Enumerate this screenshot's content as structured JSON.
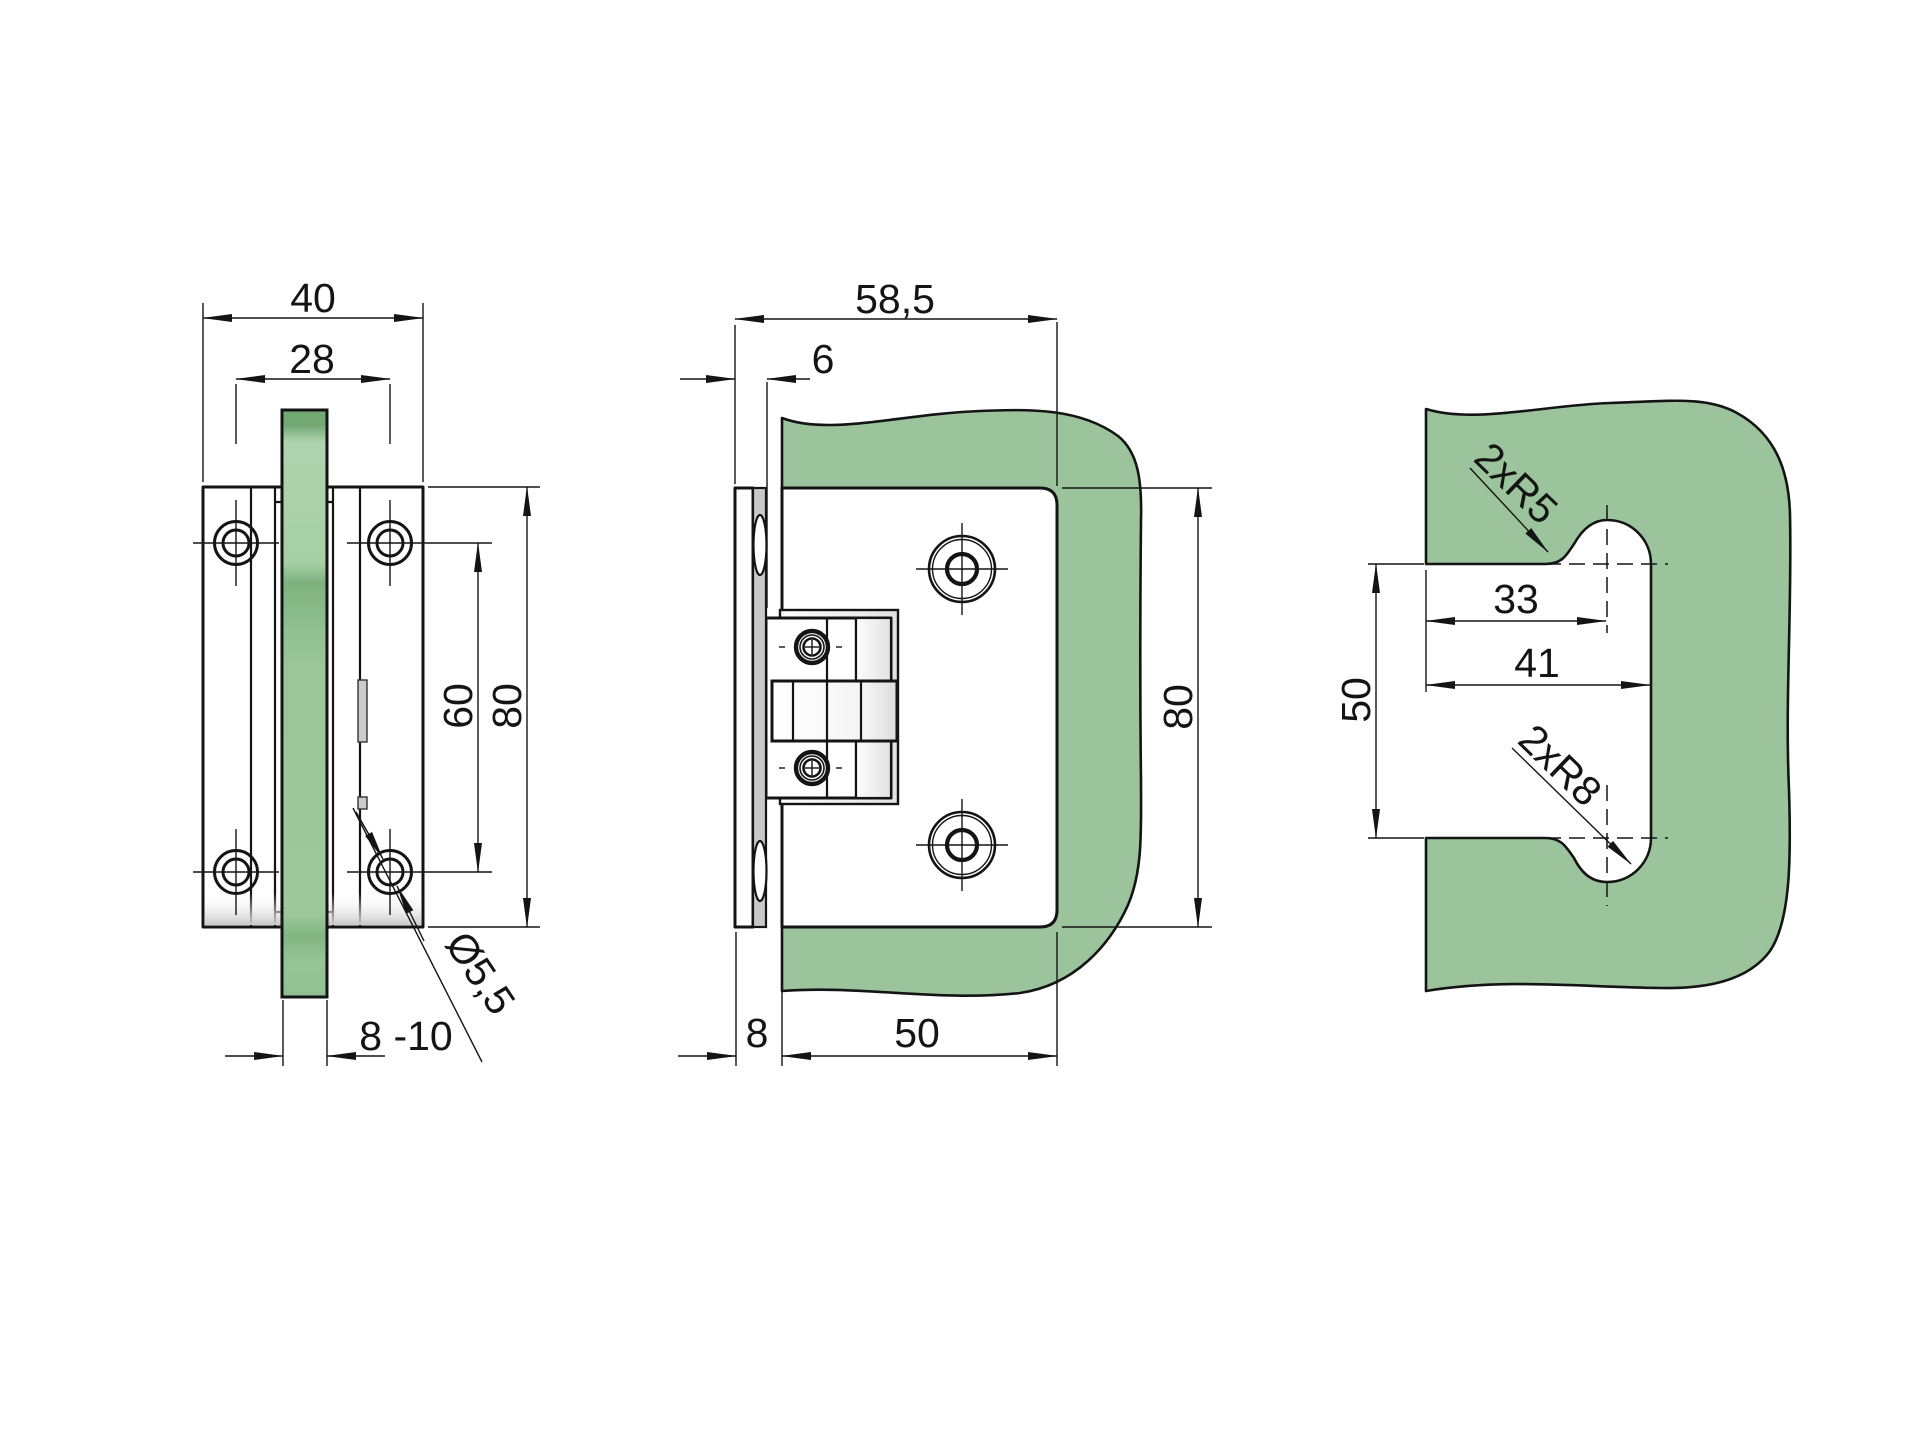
{
  "page": {
    "background": "#ffffff"
  },
  "colors": {
    "glass_green": "#9cc49c",
    "glass_light": "#b0d4b0",
    "glass_dark": "#74a974",
    "gasket_gray": "#c8c8c8",
    "pin_gray": "#cccccc",
    "line": "#141414"
  },
  "views": {
    "front": {
      "label": "hinge-front-view",
      "dims": {
        "width": "40",
        "hole_spacing": "28",
        "hole_pitch": "60",
        "height": "80",
        "glass_thickness": "8 -10",
        "hole_diameter": "Ø5,5"
      }
    },
    "side": {
      "label": "hinge-side-view",
      "dims": {
        "total_depth": "58,5",
        "wall_gap": "6",
        "height": "80",
        "plate_thickness": "8",
        "leaf_depth": "50"
      }
    },
    "cutout": {
      "label": "glass-cutout-view",
      "dims": {
        "center_offset": "33",
        "width": "41",
        "height": "50",
        "radius_top": "2xR5",
        "radius_bottom": "2xR8"
      }
    }
  }
}
